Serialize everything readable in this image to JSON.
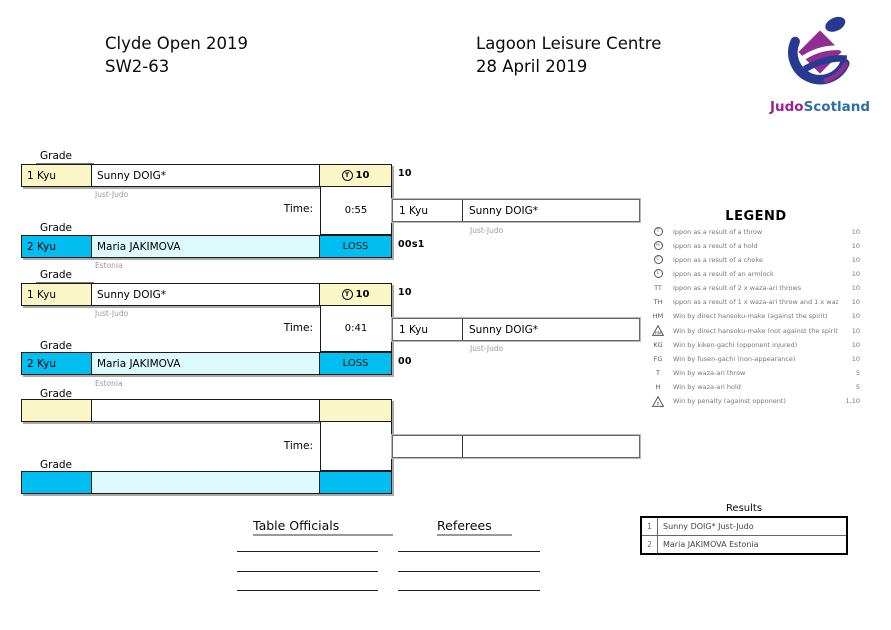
{
  "header": {
    "event_title": "Clyde Open 2019",
    "category": "SW2-63",
    "venue": "Lagoon Leisure Centre",
    "date": "28 April 2019",
    "logo": {
      "judo": "Judo",
      "scotland": "Scotland"
    }
  },
  "colors": {
    "cream": "#FAF7C6",
    "cyan": "#00BFF0",
    "light_cyan": "#DCF9FB",
    "logo_purple": "#8E2E90",
    "logo_blue": "#283A8F",
    "logo_text_purple": "#A0209A",
    "logo_text_blue": "#2E6DA8"
  },
  "bracket": {
    "grade_label": "Grade",
    "time_label": "Time:",
    "matches": [
      {
        "top": {
          "grade": "1 Kyu",
          "name": "Sunny DOIG*",
          "club": "Just-Judo",
          "score_symbol": "T",
          "score": "10",
          "outside_score": "10"
        },
        "time": "0:55",
        "bottom": {
          "grade": "2 Kyu",
          "name": "Maria JAKIMOVA",
          "club": "Estonia",
          "score_text": "LOSS",
          "outside_score": "00s1"
        },
        "winner": {
          "grade": "1 Kyu",
          "name": "Sunny DOIG*",
          "club": "Just-Judo"
        }
      },
      {
        "top": {
          "grade": "1 Kyu",
          "name": "Sunny DOIG*",
          "club": "Just-Judo",
          "score_symbol": "T",
          "score": "10",
          "outside_score": "10"
        },
        "time": "0:41",
        "bottom": {
          "grade": "2 Kyu",
          "name": "Maria JAKIMOVA",
          "club": "Estonia",
          "score_text": "LOSS",
          "outside_score": "00"
        },
        "winner": {
          "grade": "1 Kyu",
          "name": "Sunny DOIG*",
          "club": "Just-Judo"
        }
      },
      {
        "top": {
          "grade": "",
          "name": "",
          "club": "",
          "score_symbol": "",
          "score": "",
          "outside_score": ""
        },
        "time": "",
        "bottom": {
          "grade": "",
          "name": "",
          "club": "",
          "score_text": "",
          "outside_score": ""
        },
        "winner": {
          "grade": "",
          "name": "",
          "club": ""
        }
      }
    ]
  },
  "legend": {
    "title": "LEGEND",
    "entries": [
      {
        "symbol": "T",
        "type": "circle",
        "label": "Ippon as a result of a throw",
        "value": "10"
      },
      {
        "symbol": "H",
        "type": "circle",
        "label": "Ippon as a result of a hold",
        "value": "10"
      },
      {
        "symbol": "C",
        "type": "circle",
        "label": "Ippon as a result of a choke",
        "value": "10"
      },
      {
        "symbol": "L",
        "type": "circle",
        "label": "Ippon as a result of an armlock",
        "value": "10"
      },
      {
        "symbol": "TT",
        "type": "text",
        "label": "Ippon as a result of 2 x waza-ari throws",
        "value": "10"
      },
      {
        "symbol": "TH",
        "type": "text",
        "label": "Ippon as a result of 1 x waza-ari throw and 1 x waza-ari hold",
        "value": "10"
      },
      {
        "symbol": "HM",
        "type": "text",
        "label": "Win by direct hansoku-make (against the spirit)",
        "value": "10"
      },
      {
        "symbol": "HM",
        "type": "triangle",
        "label": "Win by direct hansoku-make (not against the spirit)",
        "value": "10"
      },
      {
        "symbol": "KG",
        "type": "text",
        "label": "Win by kiken-gachi (opponent injured)",
        "value": "10"
      },
      {
        "symbol": "FG",
        "type": "text",
        "label": "Win by fusen-gachi (non-appearance)",
        "value": "10"
      },
      {
        "symbol": "T",
        "type": "text",
        "label": "Win by waza-ari throw",
        "value": "5"
      },
      {
        "symbol": "H",
        "type": "text",
        "label": "Win by waza-ari hold",
        "value": "5"
      },
      {
        "symbol": "P",
        "type": "triangle",
        "label": "Win by penalty (against opponent)",
        "value": "1,10"
      }
    ]
  },
  "results": {
    "title": "Results",
    "rows": [
      {
        "rank": "1",
        "text": "Sunny DOIG* Just-Judo"
      },
      {
        "rank": "2",
        "text": "Maria JAKIMOVA Estonia"
      }
    ]
  },
  "signatures": {
    "table_officials_label": "Table Officials",
    "referees_label": "Referees"
  }
}
